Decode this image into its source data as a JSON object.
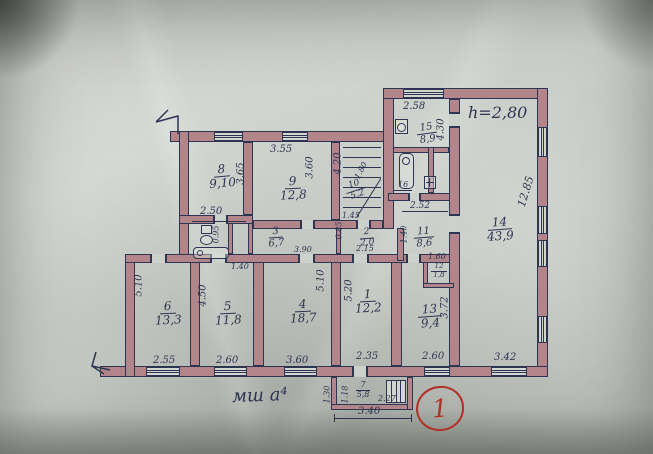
{
  "notes": {
    "height": "h=2,80",
    "sheet": "мш а⁴",
    "plan_number": "1"
  },
  "rooms": [
    {
      "n": "1",
      "a": "12,2"
    },
    {
      "n": "2",
      "a": "2,0"
    },
    {
      "n": "3",
      "a": "6,7"
    },
    {
      "n": "4",
      "a": "18,7"
    },
    {
      "n": "5",
      "a": "11,8"
    },
    {
      "n": "6",
      "a": "13,3"
    },
    {
      "n": "7",
      "a": "5,8"
    },
    {
      "n": "8",
      "a": "9,10"
    },
    {
      "n": "9",
      "a": "12,8"
    },
    {
      "n": "10",
      "a": "5,2"
    },
    {
      "n": "11",
      "a": "8,6"
    },
    {
      "n": "12",
      "a": "1,8"
    },
    {
      "n": "13",
      "a": "9,4"
    },
    {
      "n": "14",
      "a": "43,9"
    },
    {
      "n": "15",
      "a": "8,9"
    },
    {
      "n": "16",
      "a": ""
    }
  ],
  "dims": [
    "3.55",
    "2.58",
    "3.65",
    "3.60",
    "4.20",
    "4.30",
    "2.50",
    "12.85",
    "2.52",
    "1.45",
    "0.85",
    "2.15",
    "1.40",
    "3.90",
    "1.40",
    "0.95",
    "5.10",
    "4.50",
    "5.10",
    "5.20",
    "3.72",
    "1.60",
    "2.55",
    "2.60",
    "3.60",
    "2.35",
    "2.60",
    "3.42",
    "1.30",
    "1.18",
    "3.40",
    "2.27",
    "1.80"
  ]
}
